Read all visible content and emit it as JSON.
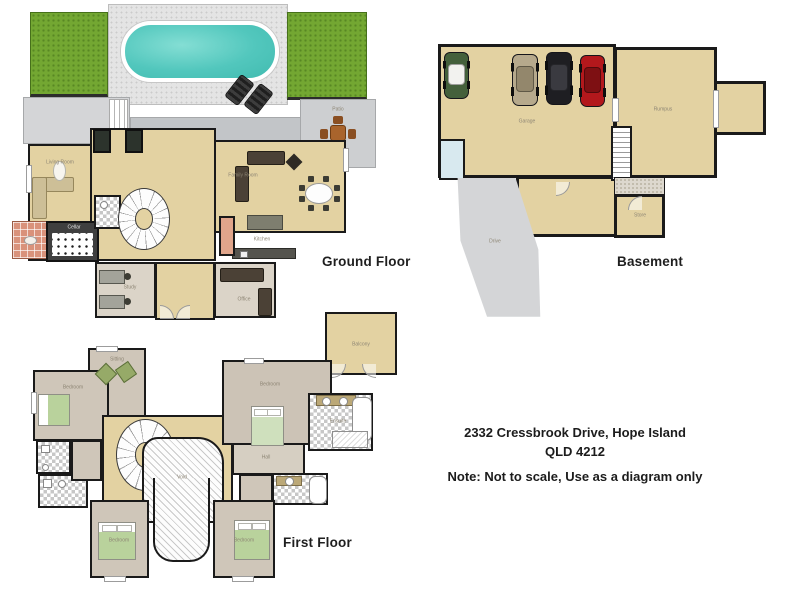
{
  "floors": {
    "ground": {
      "label": "Ground Floor",
      "rooms": {
        "living": "Living Room",
        "family": "Family Room",
        "kitchen": "Kitchen",
        "study": "Study",
        "office": "Office",
        "cellar": "Cellar",
        "patio": "Patio"
      }
    },
    "basement": {
      "label": "Basement",
      "rooms": {
        "garage": "Garage",
        "rumpus": "Rumpus",
        "store": "Store",
        "driveway": "Drive"
      }
    },
    "first": {
      "label": "First Floor",
      "rooms": {
        "sitting": "Sitting",
        "bedroom1": "Bedroom",
        "master": "Bedroom",
        "ensuite": "Ensuite",
        "bath": "Bath",
        "robe": "Robe",
        "hall": "Hall",
        "void": "Void",
        "balcony": "Balcony",
        "bedroom2": "Bedroom",
        "bedroom3": "Bedroom"
      }
    }
  },
  "address": {
    "line1": "2332 Cressbrook Drive, Hope Island",
    "line2": "QLD 4212",
    "note": "Note: Not to scale,  Use as a diagram only"
  },
  "palette": {
    "wall": "#1a1a1a",
    "floor_tan": "#e3d2a2",
    "floor_taupe": "#cfc6b9",
    "lawn_green": "#73a732",
    "pool_teal": "#52c7bd",
    "brick_salmon": "#d9927b"
  }
}
